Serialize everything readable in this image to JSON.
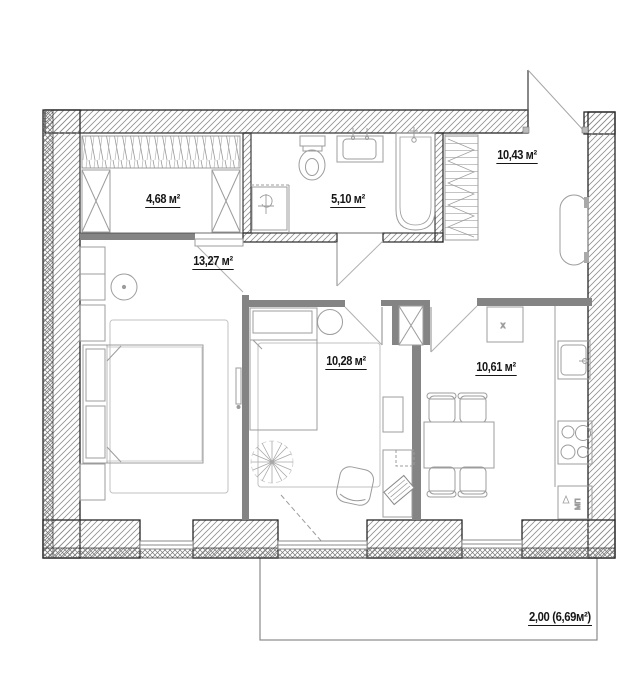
{
  "title": "apartment-floor-plan",
  "rooms": [
    {
      "id": "wardrobe",
      "area_label": "4,68 м²"
    },
    {
      "id": "bathroom",
      "area_label": "5,10 м²"
    },
    {
      "id": "hallway",
      "area_label": "10,43 м²"
    },
    {
      "id": "living-room",
      "area_label": "13,27 м²"
    },
    {
      "id": "bedroom",
      "area_label": "10,28 м²"
    },
    {
      "id": "kitchen",
      "area_label": "10,61 м²"
    },
    {
      "id": "balcony",
      "area_label": "2,00 (6,69м²)"
    }
  ],
  "annotations": {
    "cabinet_mark": "x",
    "appliance_label": "МП"
  },
  "colors": {
    "wall_outline": "#262626",
    "partition_gray": "#848484",
    "furniture_line": "#9c9c9c",
    "background": "#ffffff"
  }
}
